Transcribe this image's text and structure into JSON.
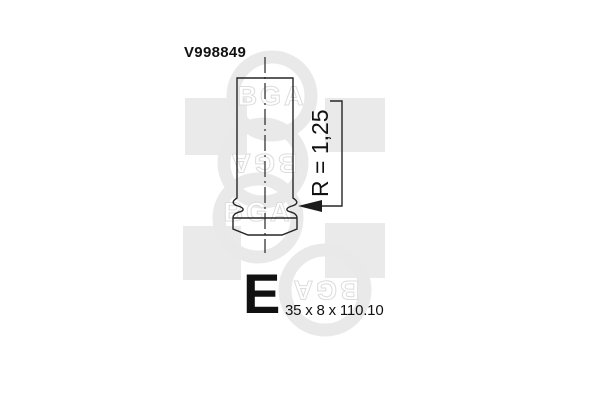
{
  "diagram": {
    "part_number": "V998849",
    "radius_label": "R = 1,25",
    "valve_type_letter": "E",
    "dimensions": "35 x 8 x 110.10"
  },
  "watermark": {
    "logo_text": "BGA"
  },
  "colors": {
    "line": "#262626",
    "text": "#111111",
    "watermark_gray": "#e9e9e9",
    "watermark_square": "#eaeaea"
  }
}
